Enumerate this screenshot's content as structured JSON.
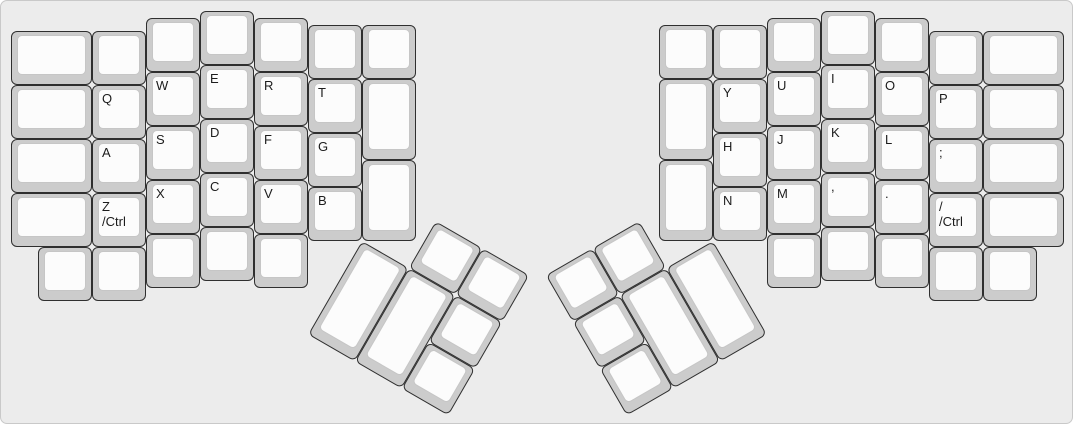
{
  "board": {
    "name": "ergodox-split-keyboard-layout",
    "background": "#ececec",
    "border_color": "#c9c9c9",
    "key_base_color": "#cccccc",
    "key_top_color": "#fcfcfc",
    "key_outline_color": "#2f2f2f",
    "keycap_border_color": "#c6c6c6",
    "label_color": "#1c1c1c",
    "unit_px": 54,
    "padding_px": 10
  },
  "keys": [
    {
      "id": "l-c0r0",
      "x": 0,
      "y": 0.375,
      "w": 1.5,
      "label": ""
    },
    {
      "id": "l-c0r1",
      "x": 0,
      "y": 1.375,
      "w": 1.5,
      "label": ""
    },
    {
      "id": "l-c0r2",
      "x": 0,
      "y": 2.375,
      "w": 1.5,
      "label": ""
    },
    {
      "id": "l-c0r3",
      "x": 0,
      "y": 3.375,
      "w": 1.5,
      "label": ""
    },
    {
      "id": "l-c1r0",
      "x": 1.5,
      "y": 0.375,
      "label": ""
    },
    {
      "id": "q",
      "x": 1.5,
      "y": 1.375,
      "label": "Q"
    },
    {
      "id": "a",
      "x": 1.5,
      "y": 2.375,
      "label": "A"
    },
    {
      "id": "z-ctrl",
      "x": 1.5,
      "y": 3.375,
      "label": "Z\n/Ctrl"
    },
    {
      "id": "l-c2r0",
      "x": 2.5,
      "y": 0.125,
      "label": ""
    },
    {
      "id": "w",
      "x": 2.5,
      "y": 1.125,
      "label": "W"
    },
    {
      "id": "s",
      "x": 2.5,
      "y": 2.125,
      "label": "S"
    },
    {
      "id": "x",
      "x": 2.5,
      "y": 3.125,
      "label": "X"
    },
    {
      "id": "l-c3r0",
      "x": 3.5,
      "y": 0,
      "label": ""
    },
    {
      "id": "e",
      "x": 3.5,
      "y": 1,
      "label": "E"
    },
    {
      "id": "d",
      "x": 3.5,
      "y": 2,
      "label": "D"
    },
    {
      "id": "c",
      "x": 3.5,
      "y": 3,
      "label": "C"
    },
    {
      "id": "l-c4r0",
      "x": 4.5,
      "y": 0.125,
      "label": ""
    },
    {
      "id": "r",
      "x": 4.5,
      "y": 1.125,
      "label": "R"
    },
    {
      "id": "f",
      "x": 4.5,
      "y": 2.125,
      "label": "F"
    },
    {
      "id": "v",
      "x": 4.5,
      "y": 3.125,
      "label": "V"
    },
    {
      "id": "l-c5r0",
      "x": 5.5,
      "y": 0.25,
      "label": ""
    },
    {
      "id": "t",
      "x": 5.5,
      "y": 1.25,
      "label": "T"
    },
    {
      "id": "g",
      "x": 5.5,
      "y": 2.25,
      "label": "G"
    },
    {
      "id": "b",
      "x": 5.5,
      "y": 3.25,
      "label": "B"
    },
    {
      "id": "l-c6r0",
      "x": 6.5,
      "y": 0.25,
      "label": ""
    },
    {
      "id": "l-c6r1",
      "x": 6.5,
      "y": 1.25,
      "h": 1.5,
      "label": ""
    },
    {
      "id": "l-c6r2",
      "x": 6.5,
      "y": 2.75,
      "h": 1.5,
      "label": ""
    },
    {
      "id": "l-b0",
      "x": 0.5,
      "y": 4.375,
      "label": ""
    },
    {
      "id": "l-b1",
      "x": 1.5,
      "y": 4.375,
      "label": ""
    },
    {
      "id": "l-b2",
      "x": 2.5,
      "y": 4.125,
      "label": ""
    },
    {
      "id": "l-b3",
      "x": 3.5,
      "y": 4,
      "label": ""
    },
    {
      "id": "l-b4",
      "x": 4.5,
      "y": 4.125,
      "label": ""
    },
    {
      "id": "l-thumb-0",
      "x": 1,
      "y": -1,
      "r": 30,
      "rx": 6.5,
      "ry": 4.25,
      "label": ""
    },
    {
      "id": "l-thumb-1",
      "x": 2,
      "y": -1,
      "r": 30,
      "rx": 6.5,
      "ry": 4.25,
      "label": ""
    },
    {
      "id": "l-thumb-2",
      "x": 0,
      "y": 0,
      "h": 2,
      "r": 30,
      "rx": 6.5,
      "ry": 4.25,
      "label": ""
    },
    {
      "id": "l-thumb-3",
      "x": 1,
      "y": 0,
      "h": 2,
      "r": 30,
      "rx": 6.5,
      "ry": 4.25,
      "label": ""
    },
    {
      "id": "l-thumb-4",
      "x": 2,
      "y": 0,
      "r": 30,
      "rx": 6.5,
      "ry": 4.25,
      "label": ""
    },
    {
      "id": "l-thumb-5",
      "x": 2,
      "y": 1,
      "r": 30,
      "rx": 6.5,
      "ry": 4.25,
      "label": ""
    },
    {
      "id": "r-thumb-0",
      "x": -3,
      "y": -1,
      "r": -30,
      "rx": 13,
      "ry": 4.25,
      "label": ""
    },
    {
      "id": "r-thumb-1",
      "x": -2,
      "y": -1,
      "r": -30,
      "rx": 13,
      "ry": 4.25,
      "label": ""
    },
    {
      "id": "r-thumb-2",
      "x": -3,
      "y": 0,
      "r": -30,
      "rx": 13,
      "ry": 4.25,
      "label": ""
    },
    {
      "id": "r-thumb-3",
      "x": -2,
      "y": 0,
      "h": 2,
      "r": -30,
      "rx": 13,
      "ry": 4.25,
      "label": ""
    },
    {
      "id": "r-thumb-4",
      "x": -1,
      "y": 0,
      "h": 2,
      "r": -30,
      "rx": 13,
      "ry": 4.25,
      "label": ""
    },
    {
      "id": "r-thumb-5",
      "x": -3,
      "y": 1,
      "r": -30,
      "rx": 13,
      "ry": 4.25,
      "label": ""
    },
    {
      "id": "r-c0r0",
      "x": 12,
      "y": 0.25,
      "label": ""
    },
    {
      "id": "r-c0r1",
      "x": 12,
      "y": 1.25,
      "h": 1.5,
      "label": ""
    },
    {
      "id": "r-c0r2",
      "x": 12,
      "y": 2.75,
      "h": 1.5,
      "label": ""
    },
    {
      "id": "r-c1r0",
      "x": 13,
      "y": 0.25,
      "label": ""
    },
    {
      "id": "y",
      "x": 13,
      "y": 1.25,
      "label": "Y"
    },
    {
      "id": "h",
      "x": 13,
      "y": 2.25,
      "label": "H"
    },
    {
      "id": "n",
      "x": 13,
      "y": 3.25,
      "label": "N"
    },
    {
      "id": "r-c2r0",
      "x": 14,
      "y": 0.125,
      "label": ""
    },
    {
      "id": "u",
      "x": 14,
      "y": 1.125,
      "label": "U"
    },
    {
      "id": "j",
      "x": 14,
      "y": 2.125,
      "label": "J"
    },
    {
      "id": "m",
      "x": 14,
      "y": 3.125,
      "label": "M"
    },
    {
      "id": "r-c3r0",
      "x": 15,
      "y": 0,
      "label": ""
    },
    {
      "id": "i",
      "x": 15,
      "y": 1,
      "label": "I"
    },
    {
      "id": "k",
      "x": 15,
      "y": 2,
      "label": "K"
    },
    {
      "id": "comma",
      "x": 15,
      "y": 3,
      "label": ","
    },
    {
      "id": "r-c4r0",
      "x": 16,
      "y": 0.125,
      "label": ""
    },
    {
      "id": "o",
      "x": 16,
      "y": 1.125,
      "label": "O"
    },
    {
      "id": "l",
      "x": 16,
      "y": 2.125,
      "label": "L"
    },
    {
      "id": "period",
      "x": 16,
      "y": 3.125,
      "label": "."
    },
    {
      "id": "r-c5r0",
      "x": 17,
      "y": 0.375,
      "label": ""
    },
    {
      "id": "p",
      "x": 17,
      "y": 1.375,
      "label": "P"
    },
    {
      "id": "semicolon",
      "x": 17,
      "y": 2.375,
      "label": ";"
    },
    {
      "id": "slash-ctrl",
      "x": 17,
      "y": 3.375,
      "label": "/\n/Ctrl"
    },
    {
      "id": "r-c6r0",
      "x": 18,
      "y": 0.375,
      "w": 1.5,
      "label": ""
    },
    {
      "id": "r-c6r1",
      "x": 18,
      "y": 1.375,
      "w": 1.5,
      "label": ""
    },
    {
      "id": "r-c6r2",
      "x": 18,
      "y": 2.375,
      "w": 1.5,
      "label": ""
    },
    {
      "id": "r-c6r3",
      "x": 18,
      "y": 3.375,
      "w": 1.5,
      "label": ""
    },
    {
      "id": "r-b0",
      "x": 14,
      "y": 4.125,
      "label": ""
    },
    {
      "id": "r-b1",
      "x": 15,
      "y": 4,
      "label": ""
    },
    {
      "id": "r-b2",
      "x": 16,
      "y": 4.125,
      "label": ""
    },
    {
      "id": "r-b3",
      "x": 17,
      "y": 4.375,
      "label": ""
    },
    {
      "id": "r-b4",
      "x": 18,
      "y": 4.375,
      "label": ""
    }
  ]
}
